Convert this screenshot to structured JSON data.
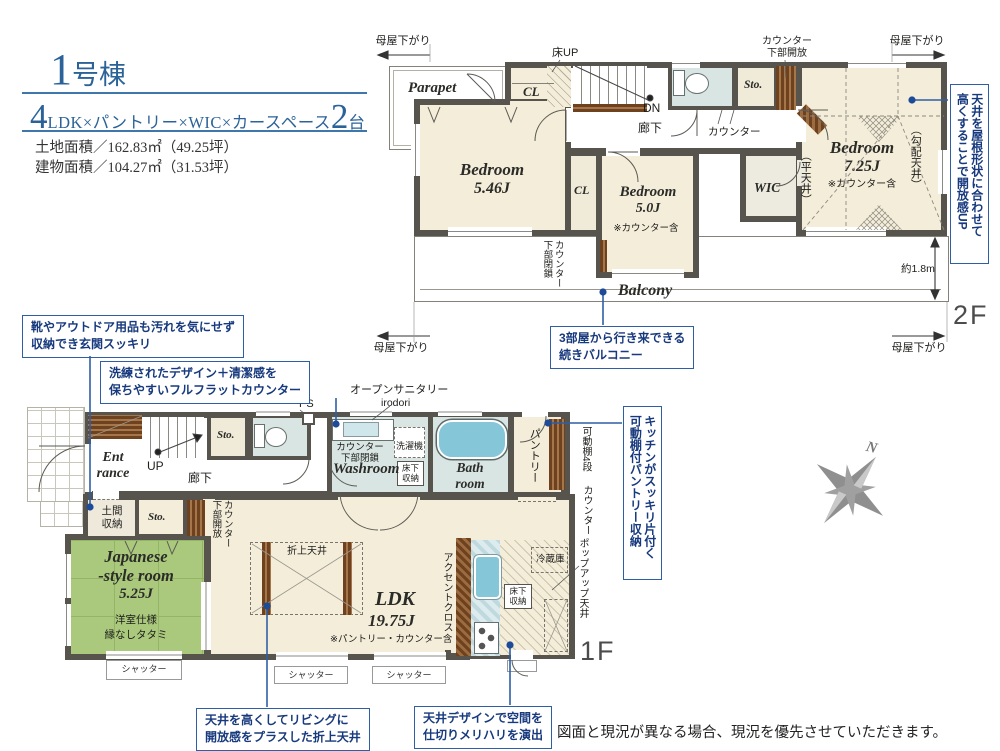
{
  "header": {
    "num": "1",
    "num_suffix": "号棟",
    "spec_big1": "4",
    "spec_mid": "LDK×パントリー×WIC×カースペース",
    "spec_big2": "2",
    "spec_end": "台",
    "land": "土地面積／162.83㎡（49.25坪）",
    "bldg": "建物面積／104.27㎡（31.53坪）"
  },
  "f2": {
    "floor": "2F",
    "moya_tl": "母屋下がり",
    "moya_tr": "母屋下がり",
    "moya_bl": "母屋下がり",
    "moya_br": "母屋下がり",
    "yuka_up": "床UP",
    "parapet": "Parapet",
    "cl_top": "CL",
    "dn": "DN",
    "hall": "廊下",
    "counter": "カウンター",
    "sto": "Sto.",
    "counter_open_1": "カウンター",
    "counter_open_2": "下部開放",
    "bed1_name": "Bedroom",
    "bed1_size": "5.46J",
    "cl_mid": "CL",
    "bed2_name": "Bedroom",
    "bed2_size": "5.0J",
    "bed2_note": "※カウンター含",
    "counter_closed_1": "カウンター",
    "counter_closed_2": "下部閉鎖",
    "wic": "WIC",
    "flat_ceil": "（平天井）",
    "bed3_name": "Bedroom",
    "bed3_size": "7.25J",
    "bed3_note": "※カウンター含",
    "slope_ceil": "（勾配天井）",
    "balcony": "Balcony",
    "dim": "約1.8m"
  },
  "f1": {
    "floor": "1F",
    "ps": "PS",
    "open_sanitary": "オープンサニタリー",
    "irodori": "irodori",
    "washer": "洗濯機",
    "counter_closed_1": "カウンター",
    "counter_closed_2": "下部閉鎖",
    "washroom": "Washroom",
    "floor_storage_1a": "床下",
    "floor_storage_1b": "収納",
    "bath_1": "Bath",
    "bath_2": "room",
    "pantry": "パントリー",
    "shelf": "可動棚4段",
    "counter_r": "カウンター",
    "entrance_1": "Ent",
    "entrance_2": "rance",
    "up": "UP",
    "hall": "廊下",
    "sto_hall": "Sto.",
    "doma_1": "土間",
    "doma_2": "収納",
    "sto_ldk": "Sto.",
    "counter_open_1": "カウンター",
    "counter_open_2": "下部開放",
    "jp_1": "Japanese",
    "jp_2": "-style room",
    "jp_3": "5.25J",
    "jp_4": "洋室仕様",
    "jp_5": "縁なしタタミ",
    "orie_ceiling": "折上天井",
    "ldk": "LDK",
    "ldk_size": "19.75J",
    "ldk_note": "※パントリー・カウンター含",
    "accent": "アクセントクロス",
    "fridge": "冷蔵庫",
    "floor_storage_2a": "床下",
    "floor_storage_2b": "収納",
    "popup": "ポップアップ天井",
    "shutter": "シャッター"
  },
  "callouts": {
    "c1_1": "靴やアウトドア用品も汚れを気にせず",
    "c1_2": "収納でき玄関スッキリ",
    "c2_1": "洗練されたデザイン＋清潔感を",
    "c2_2": "保ちやすいフルフラットカウンター",
    "c3_1": "3部屋から行き来できる",
    "c3_2": "続きバルコニー",
    "c4_1": "天井を屋根形状に合わせて",
    "c4_2": "高くすることで開放感UP",
    "c5_1": "キッチンがスッキリ片付く",
    "c5_2": "可動棚付パントリー収納",
    "c6_1": "天井を高くしてリビングに",
    "c6_2": "開放感をプラスした折上天井",
    "c7_1": "天井デザインで空間を",
    "c7_2": "仕切りメリハリを演出"
  },
  "compass": "N",
  "disclaimer": "図面と現況が異なる場合、現況を優先させていただきます。",
  "colors": {
    "accent_blue": "#2e5fa6",
    "text_blue": "#17397d",
    "title_blue": "#2b6399",
    "wall": "#57544d",
    "tatami": "#abc97d",
    "wet": "#d8e5e2",
    "wood": "#6f421f",
    "cream": "#f3edd9"
  }
}
